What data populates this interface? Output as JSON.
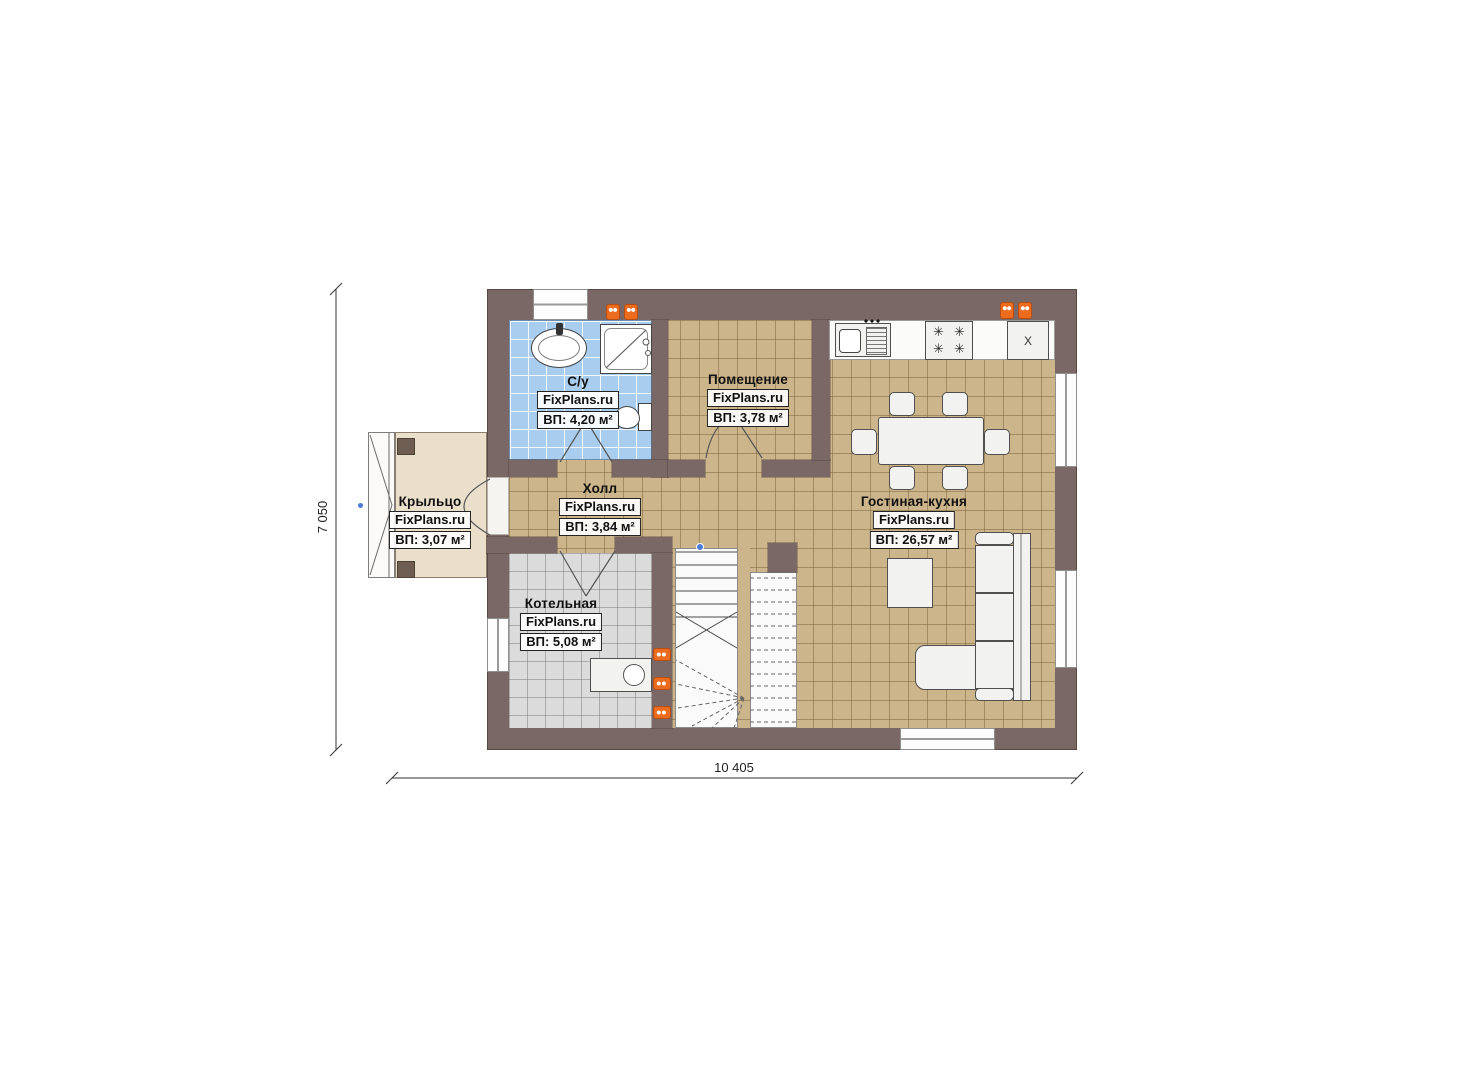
{
  "site_brand": "FixPlans.ru",
  "rooms": {
    "bathroom": {
      "name": "С/у",
      "brand": "FixPlans.ru",
      "area": "ВП: 4,20 м²"
    },
    "utility": {
      "name": "Помещение",
      "brand": "FixPlans.ru",
      "area": "ВП: 3,78 м²"
    },
    "porch": {
      "name": "Крыльцо",
      "brand": "FixPlans.ru",
      "area": "ВП: 3,07 м²"
    },
    "hall": {
      "name": "Холл",
      "brand": "FixPlans.ru",
      "area": "ВП: 3,84 м²"
    },
    "boiler": {
      "name": "Котельная",
      "brand": "FixPlans.ru",
      "area": "ВП: 5,08 м²"
    },
    "living": {
      "name": "Гостиная-кухня",
      "brand": "FixPlans.ru",
      "area": "ВП: 26,57 м²"
    }
  },
  "dimensions": {
    "overall_width_mm": "10 405",
    "overall_height_mm": "7 050"
  },
  "appliances": {
    "fridge_label": "X"
  },
  "colors": {
    "wall": "#7a6866",
    "floor_tile": "#cdb58b",
    "bathroom_tile": "#a9cdee",
    "boiler_tile": "#dbdbdb",
    "porch_floor": "#eadfcb",
    "radiator": "#ec6b1d",
    "marker": "#4b7bd5"
  }
}
